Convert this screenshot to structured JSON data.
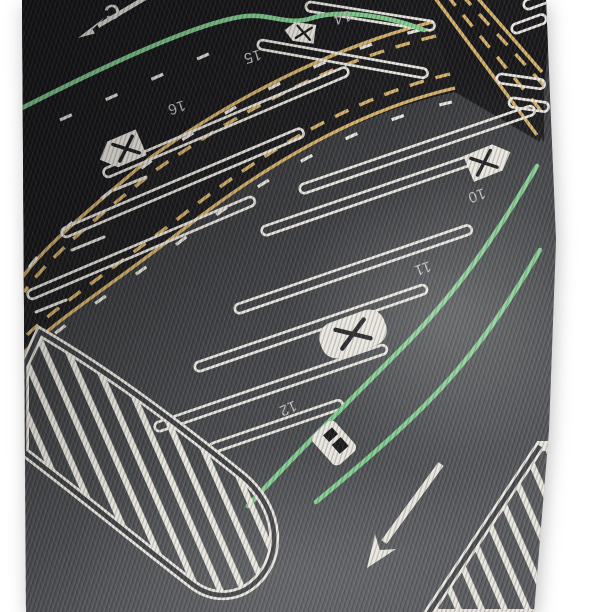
{
  "scene": {
    "description": "Close-up photograph of a dark ribbed knit fabric printed with a parking-lot road-map pattern (numbered stalls, crossed-out stalls, green and yellow lane lines, hatched islands and lane arrows), lying on a white background",
    "colors": {
      "page_bg": "#ffffff",
      "fabric_base": "#3a3b3e",
      "asphalt_black": "#17171a",
      "asphalt_mid": "#303134",
      "asphalt_light": "#55575a",
      "ink_black": "#1b1b1d",
      "marking_white": "#eae7df",
      "marking_dim": "#c5c2bb",
      "marking_green": "#82cf90",
      "marking_yellow": "#d6b26a"
    }
  },
  "print": {
    "stall_numbers_top_row": [
      "14",
      "15",
      "16"
    ],
    "stall_numbers_bottom_row": [
      "10",
      "11",
      "12"
    ],
    "partial_edge_letter": "C"
  }
}
